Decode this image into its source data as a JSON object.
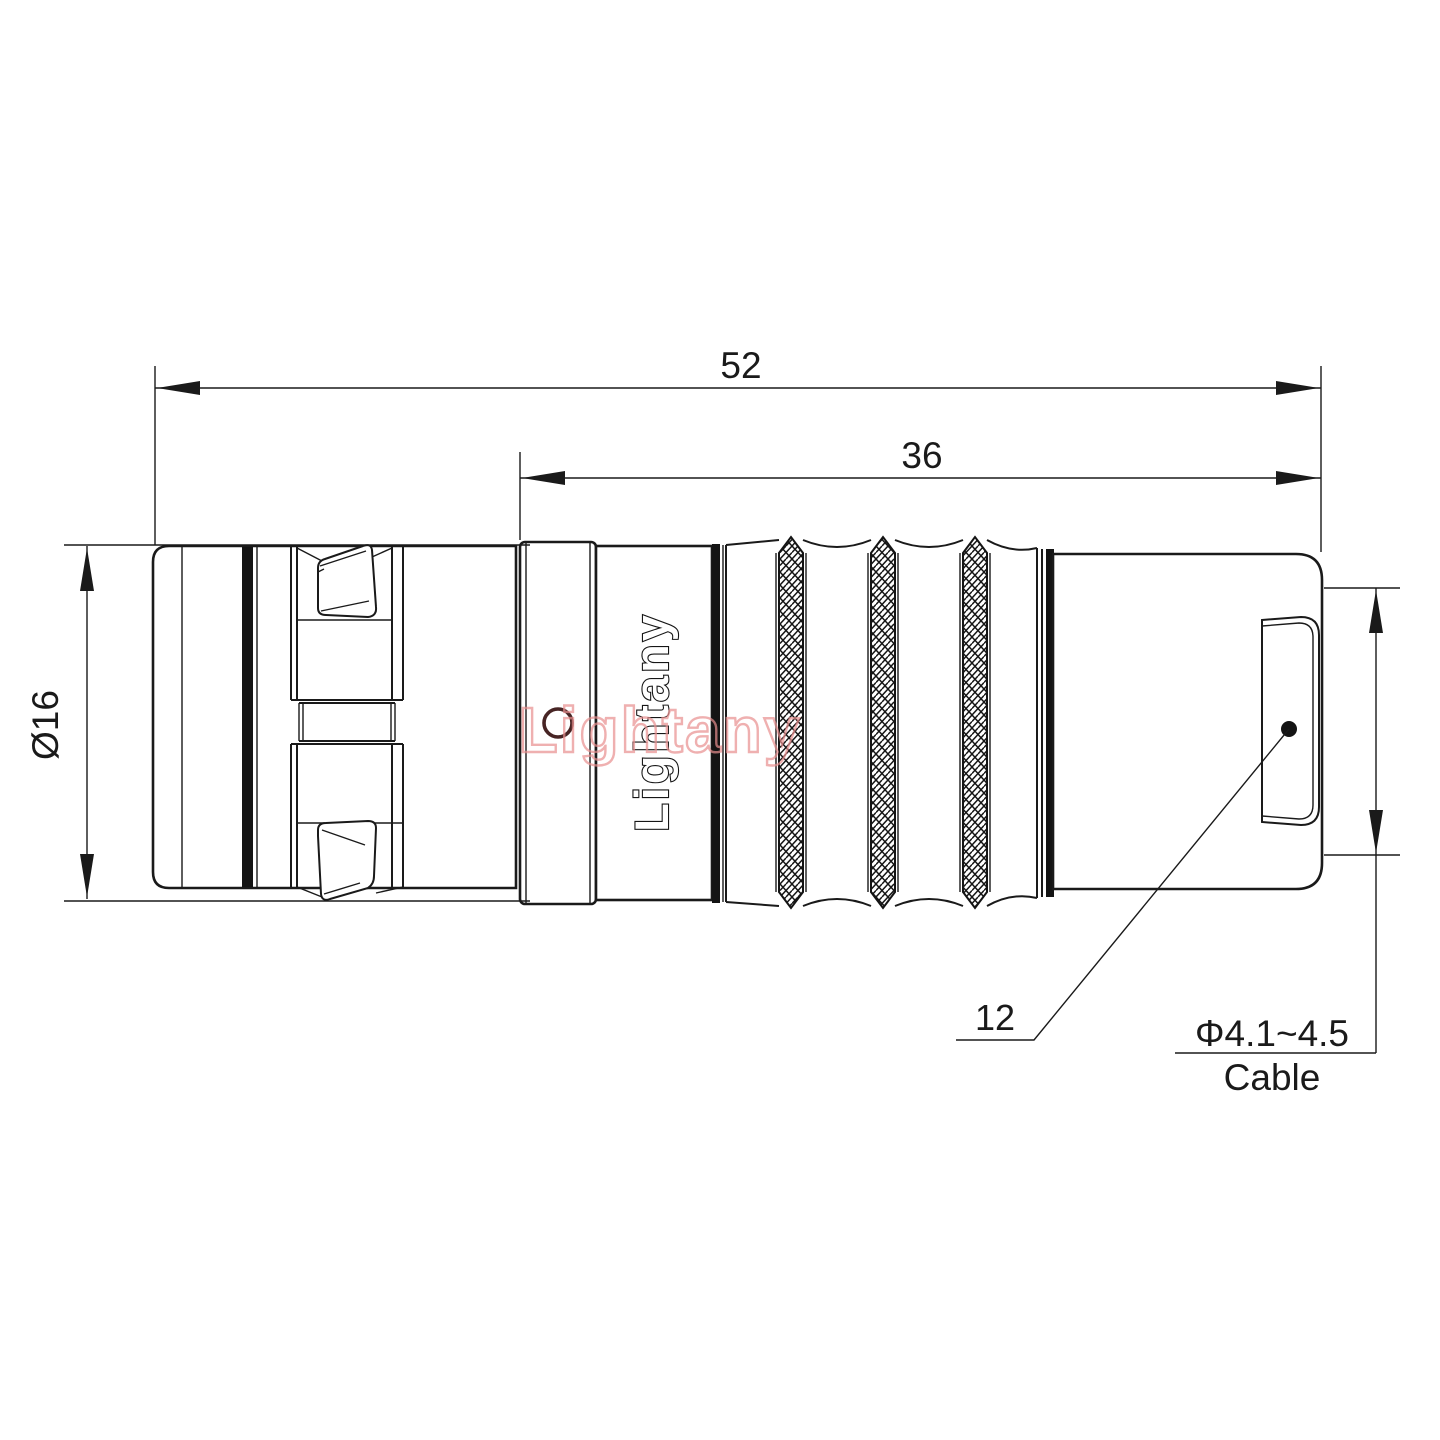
{
  "page": {
    "background": "#ffffff"
  },
  "drawing": {
    "line_color": "#1a1a1a",
    "watermark_color": "#e98f8f",
    "logo_text": "Lightany",
    "watermark_text": "Lightany",
    "dimensions": {
      "overall_length": "52",
      "mid_length": "36",
      "front_diameter": "Ø16",
      "boot_size": "12",
      "cable_diameter": "Φ4.1~4.5",
      "cable_word": "Cable"
    }
  }
}
